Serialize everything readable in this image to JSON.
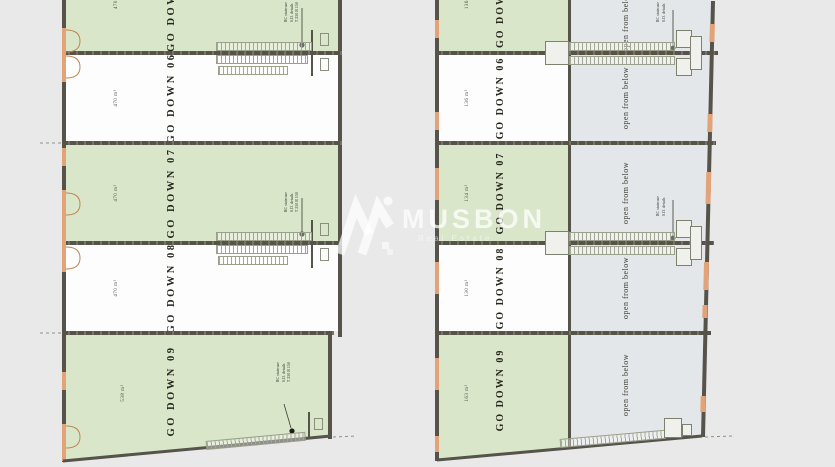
{
  "watermark": {
    "brand": "MUSBON",
    "subtitle": "Real Estate"
  },
  "stair_note": {
    "l1": "RC staircase",
    "l2": "S.D. details",
    "l3": "T 250 R 150"
  },
  "left_building": {
    "units": [
      {
        "label": "GO DOWN 05",
        "area": "470 m²"
      },
      {
        "label": "GO DOWN 06",
        "area": "470 m²"
      },
      {
        "label": "GO DOWN 07",
        "area": "470 m²"
      },
      {
        "label": "GO DOWN 08",
        "area": "470 m²"
      },
      {
        "label": "GO DOWN 09",
        "area": "538 m²"
      }
    ]
  },
  "right_building": {
    "open_label": "open from below",
    "units": [
      {
        "label": "GO DOWN 05",
        "area": "136 m²"
      },
      {
        "label": "GO DOWN 06",
        "area": "136 m²"
      },
      {
        "label": "GO DOWN 07",
        "area": "134 m²"
      },
      {
        "label": "GO DOWN 08",
        "area": "130 m²"
      },
      {
        "label": "GO DOWN 09",
        "area": "163 m²"
      }
    ]
  },
  "colors": {
    "background": "#e9e9e9",
    "unit_green": "#d9e6ca",
    "unit_white": "#fdfdfd",
    "open_grey": "#e4e7ea",
    "wall_dark": "#55534a",
    "accent_orange": "#e2a379"
  }
}
